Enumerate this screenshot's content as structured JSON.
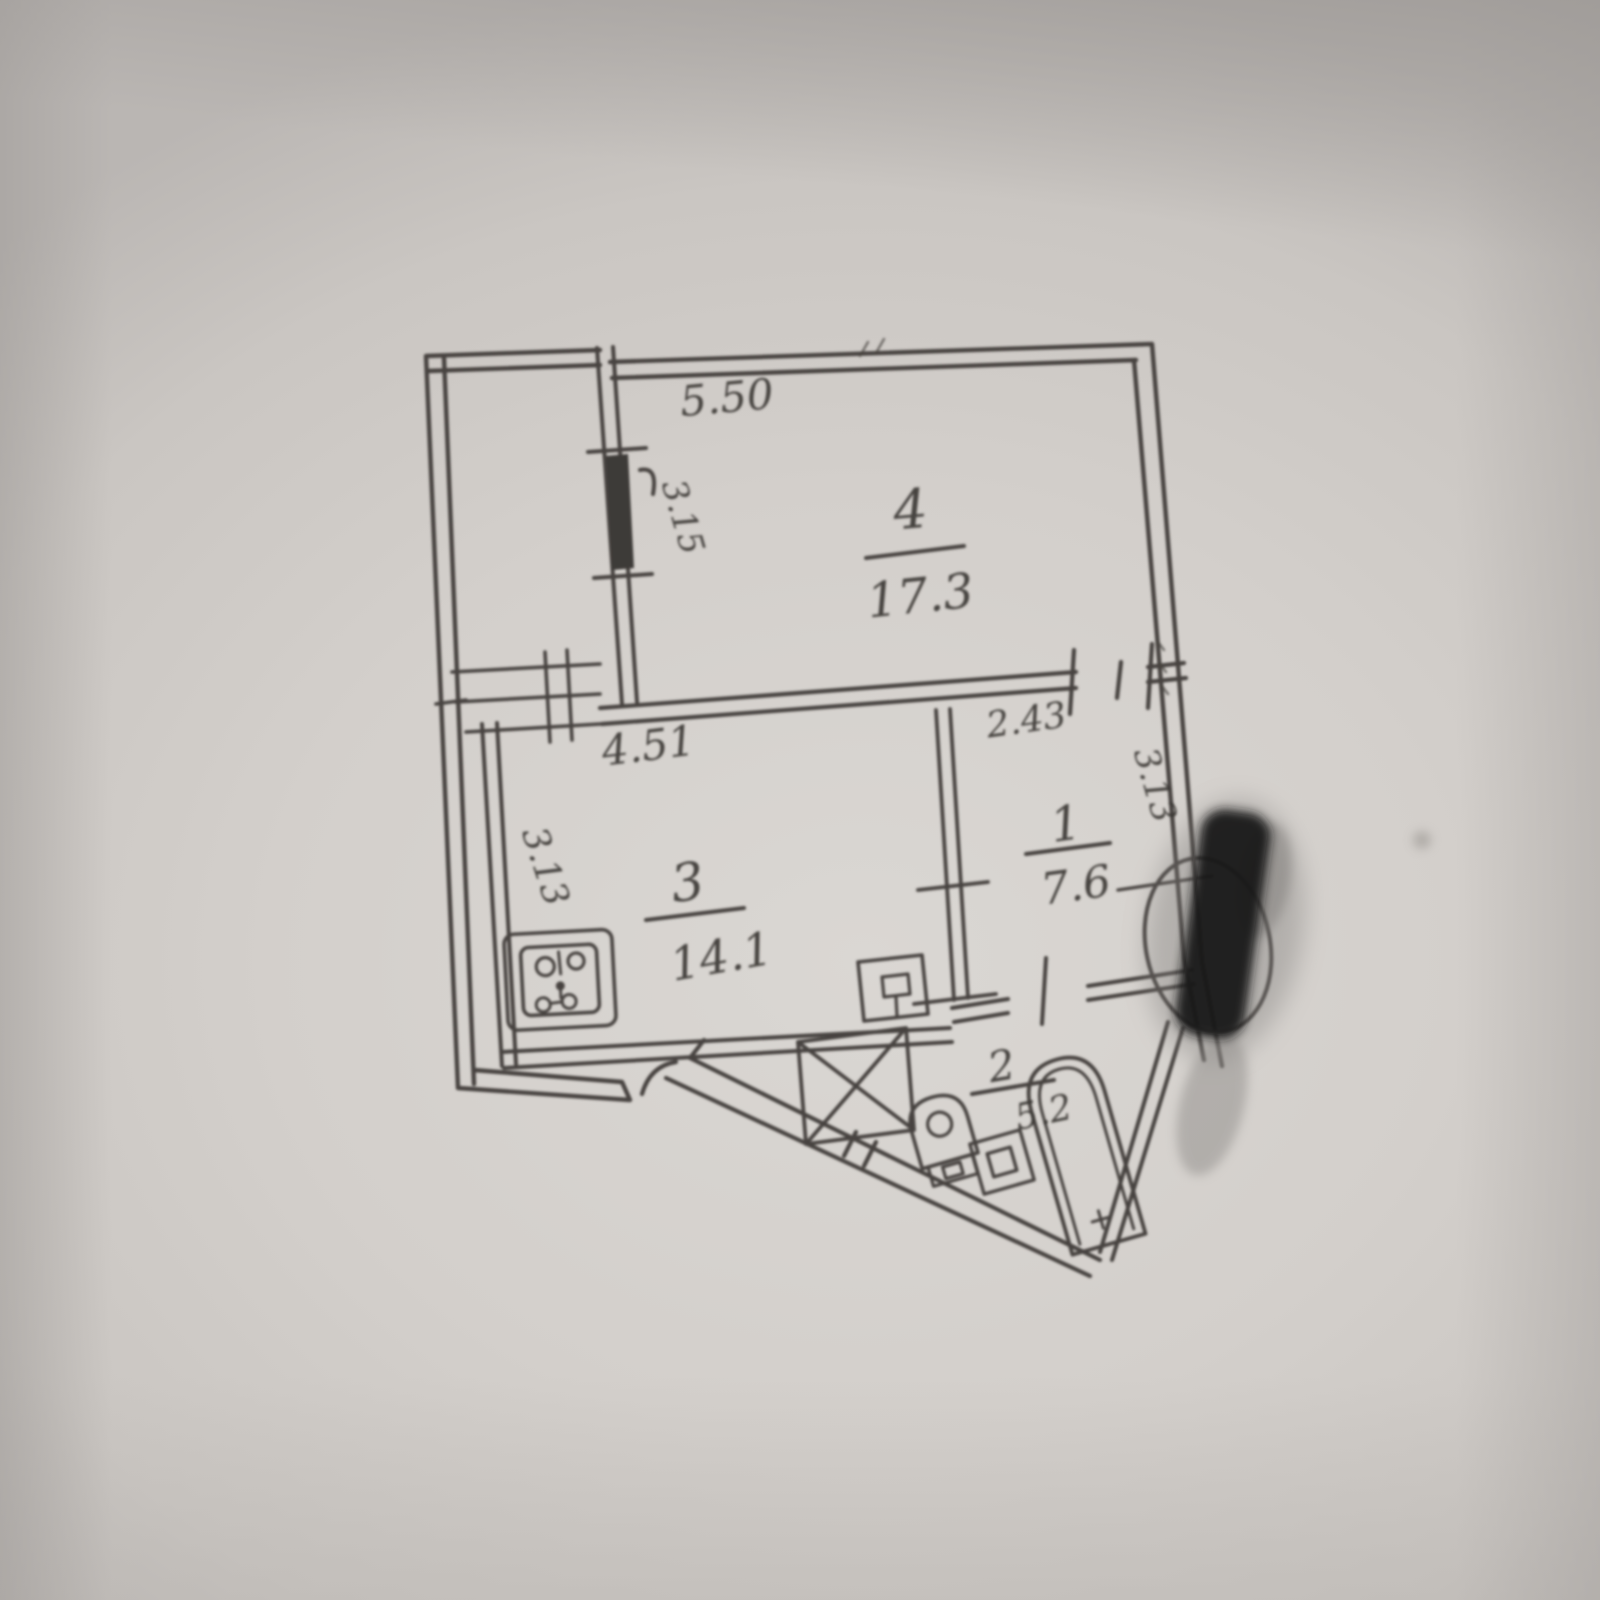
{
  "plan": {
    "rooms": [
      {
        "number": "4",
        "area": "17.3"
      },
      {
        "number": "3",
        "area": "14.1"
      },
      {
        "number": "1",
        "area": "7.6"
      },
      {
        "number": "2",
        "area": "5.2"
      }
    ],
    "dimensions": {
      "room4_top_width": "5.50",
      "room4_left_depth": "3.15",
      "room3_top_width": "4.51",
      "room3_left_depth": "3.13",
      "room1_top_width": "2.43",
      "room1_right_depth": "3.13"
    },
    "fixtures": [
      "stove",
      "kitchen-sink",
      "wardrobe",
      "toilet",
      "washbasin",
      "bathtub",
      "balcony"
    ],
    "colors": {
      "paper": "#d3cfcb",
      "ink": "#46433f",
      "redaction": "#171717"
    }
  }
}
